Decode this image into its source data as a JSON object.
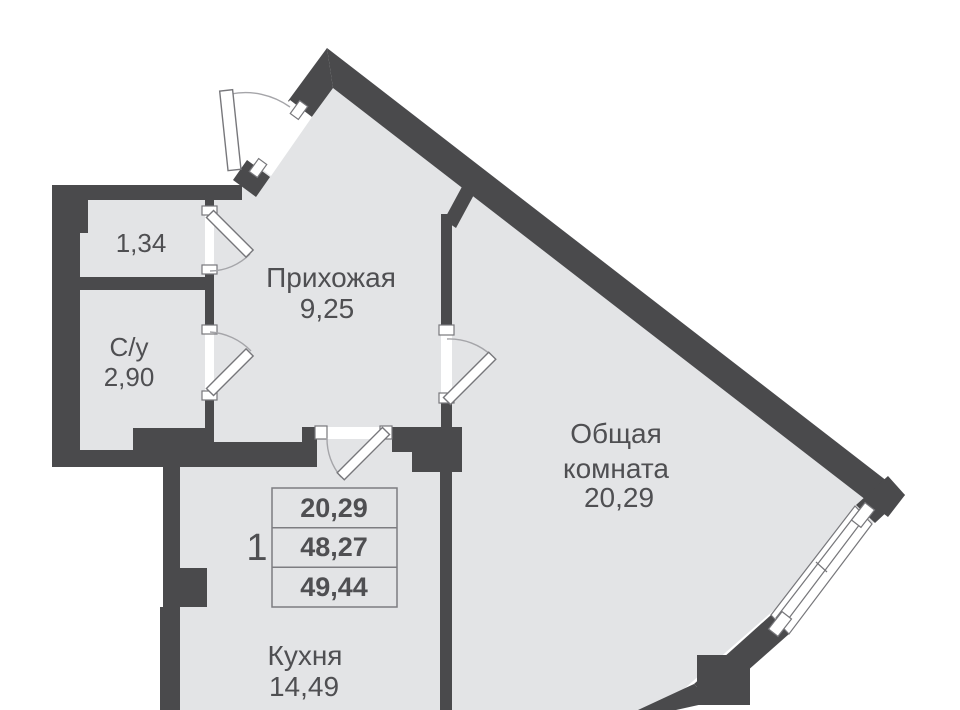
{
  "plan": {
    "rooms": [
      {
        "key": "storage",
        "area": "1,34"
      },
      {
        "key": "bathroom",
        "name": "С/у",
        "area": "2,90"
      },
      {
        "key": "hallway",
        "name": "Прихожая",
        "area": "9,25"
      },
      {
        "key": "living",
        "name_line1": "Общая",
        "name_line2": "комната",
        "area": "20,29"
      },
      {
        "key": "kitchen",
        "name": "Кухня",
        "area": "14,49"
      }
    ],
    "legend": {
      "flat_number": "1",
      "rows": [
        {
          "value": "20,29"
        },
        {
          "value": "48,27"
        },
        {
          "value": "49,44"
        }
      ]
    },
    "colors": {
      "wall": "#4a4a4c",
      "floor": "#e3e4e6",
      "outside": "#ffffff",
      "text": "#4f4f52",
      "arc": "#a5a5a9",
      "table_border": "#7d7d81"
    }
  }
}
